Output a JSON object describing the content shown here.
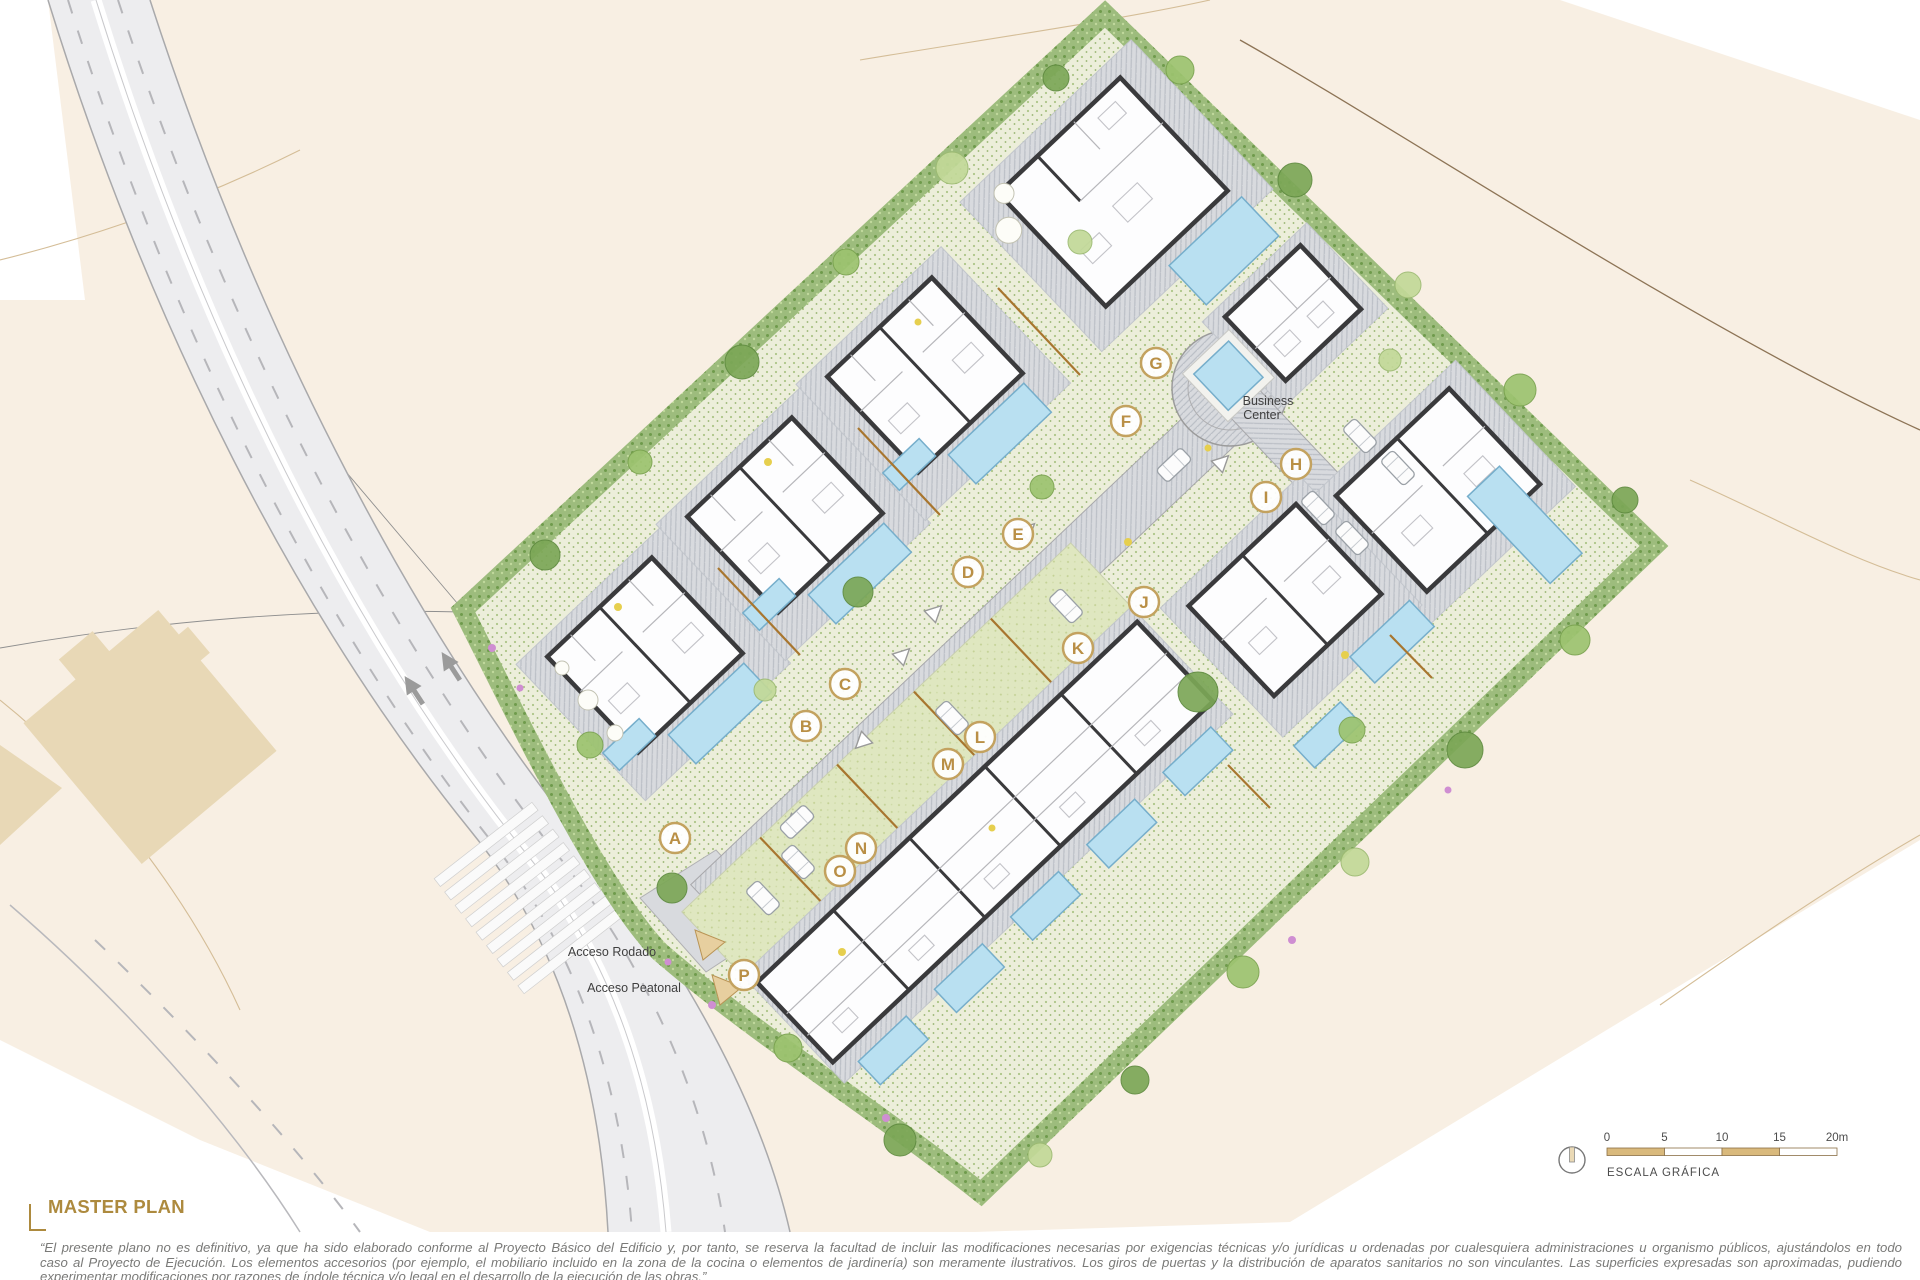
{
  "sheet": {
    "title": "MASTER PLAN"
  },
  "disclaimer": {
    "line1": "“El presente plano no es definitivo, ya que ha sido elaborado conforme al Proyecto Básico del Edificio y, por tanto, se reserva la facultad de incluir las modificaciones necesarias por exigencias técnicas y/o jurídicas u ordenadas por cualesquiera administraciones u organismo públicos, ajustándolos en todo",
    "line2": "caso al Proyecto de Ejecución. Los elementos accesorios (por ejemplo, el mobiliario incluido en la zona de la cocina o elementos de jardinería) son meramente ilustrativos. Los giros de puertas y la distribución de aparatos sanitarios no son vinculantes. Las superficies expresadas son aproximadas, pudiendo",
    "line3": "experimentar modificaciones por razones de índole técnica y/o legal en el desarrollo de la ejecución de las obras.”"
  },
  "scale_bar": {
    "caption": "ESCALA GRÁFICA",
    "ticks": [
      "0",
      "5",
      "10",
      "15",
      "20m"
    ]
  },
  "plan_labels": {
    "business_center": [
      "Business",
      "Center"
    ],
    "acceso_rodado": "Acceso Rodado",
    "acceso_peatonal": "Acceso Peatonal"
  },
  "site": {
    "units": [
      {
        "label": "A",
        "x": 675,
        "y": 838
      },
      {
        "label": "B",
        "x": 806,
        "y": 726
      },
      {
        "label": "C",
        "x": 845,
        "y": 684
      },
      {
        "label": "D",
        "x": 968,
        "y": 572
      },
      {
        "label": "E",
        "x": 1018,
        "y": 534
      },
      {
        "label": "F",
        "x": 1126,
        "y": 421
      },
      {
        "label": "G",
        "x": 1156,
        "y": 363
      },
      {
        "label": "H",
        "x": 1296,
        "y": 464
      },
      {
        "label": "I",
        "x": 1266,
        "y": 497
      },
      {
        "label": "J",
        "x": 1144,
        "y": 602
      },
      {
        "label": "K",
        "x": 1078,
        "y": 648
      },
      {
        "label": "L",
        "x": 980,
        "y": 737
      },
      {
        "label": "M",
        "x": 948,
        "y": 764
      },
      {
        "label": "N",
        "x": 861,
        "y": 848
      },
      {
        "label": "O",
        "x": 840,
        "y": 871
      },
      {
        "label": "P",
        "x": 744,
        "y": 975
      }
    ]
  },
  "colors": {
    "accent_gold": "#ad8a3e",
    "badge_ring": "#c3a25f",
    "pool_blue": "#b9e0f1",
    "hedge_green": "#9dbc7d",
    "terrain_beige": "#f8efe3",
    "road_gray": "#ededef",
    "lawn_green": "#dfe7c0",
    "building_wall": "#3a3a3c",
    "scale_tan": "#d9b97c"
  }
}
